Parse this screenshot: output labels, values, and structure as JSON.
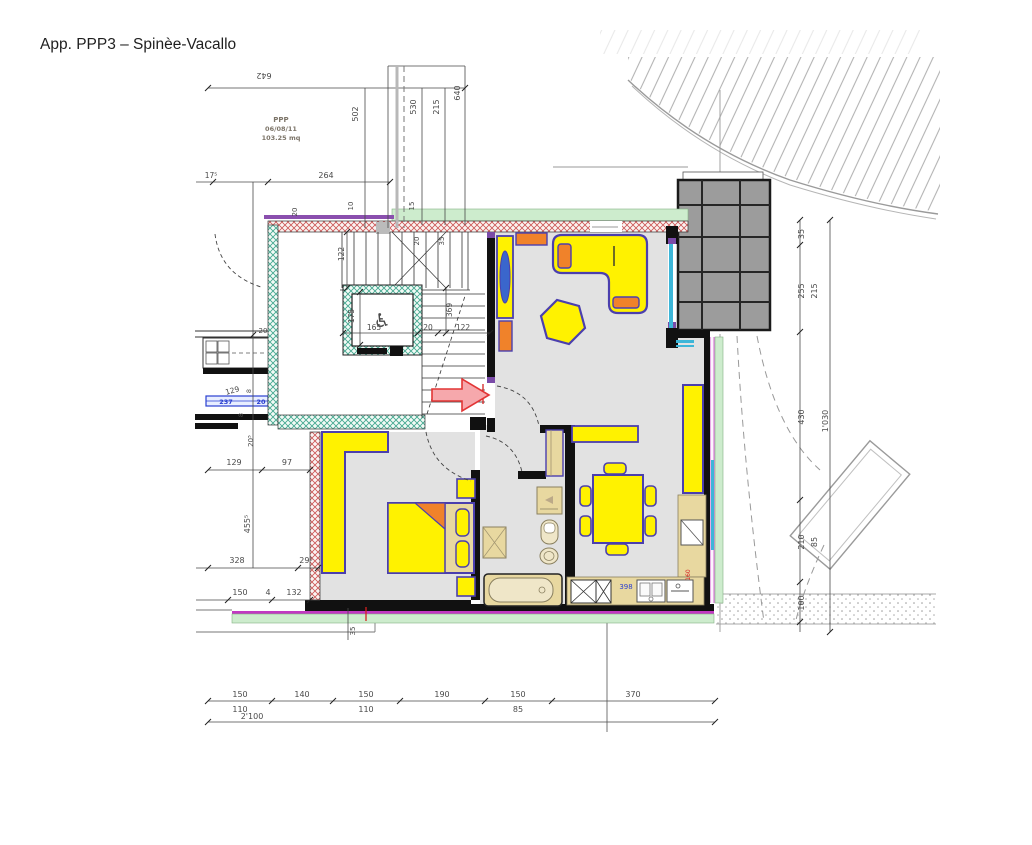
{
  "page": {
    "title": "App. PPP3 – Spinèe-Vacallo"
  },
  "info_box": {
    "name": "PPP",
    "date": "06/08/11",
    "area": "103.25 mq"
  },
  "icons": {
    "wheelchair": "♿"
  },
  "dims_top": {
    "t642": "642",
    "t502": "502",
    "t530": "530",
    "t215": "215",
    "t640": "640",
    "t175": "17⁵",
    "t264": "264",
    "t20": "20",
    "t10": "10",
    "t15": "15",
    "w20": "20",
    "w35": "35"
  },
  "dims_stair": {
    "s122": "122",
    "e175": "175",
    "s369": "369",
    "e165": "165",
    "e20": "20",
    "s122b": "122"
  },
  "dims_left": {
    "l20": "20",
    "l129": "129",
    "l8a": "8",
    "l8b": "8",
    "l237": "237",
    "l20b": "20",
    "l205": "20⁵",
    "l129b": "129",
    "l97": "97",
    "l455": "455⁵",
    "l328": "328",
    "l295": "29⁵",
    "l150": "150",
    "l4": "4",
    "l132": "132",
    "bl35": "35"
  },
  "dims_right": {
    "r35": "35",
    "r255": "255",
    "r215": "215",
    "r430": "430",
    "r1030": "1'030",
    "r210": "210",
    "r85": "85",
    "r100": "100"
  },
  "dims_bottom": {
    "b150a": "150",
    "b140": "140",
    "b150b": "150",
    "b190": "190",
    "b150c": "150",
    "b370": "370",
    "b110a": "110",
    "b110b": "110",
    "b85": "85",
    "btotal": "2'100"
  },
  "dims_kitchen": {
    "k398": "398",
    "k160": "160"
  },
  "colors": {
    "furniture_yellow": "#fff200",
    "outline_purple": "#4b3fae",
    "accent_orange": "#f0822a",
    "fixture_beige": "#e8d8a0",
    "insulation_green": "#cdeccd",
    "wall_hatch_red": "#cc5555",
    "window_cyan": "#3db6d8",
    "terrace_gray": "#9c9c9c",
    "arrow_pink": "#f6a8ac",
    "arrow_red": "#e23535",
    "dim_blue": "#2a3fd0",
    "dim_red": "#d42020"
  }
}
